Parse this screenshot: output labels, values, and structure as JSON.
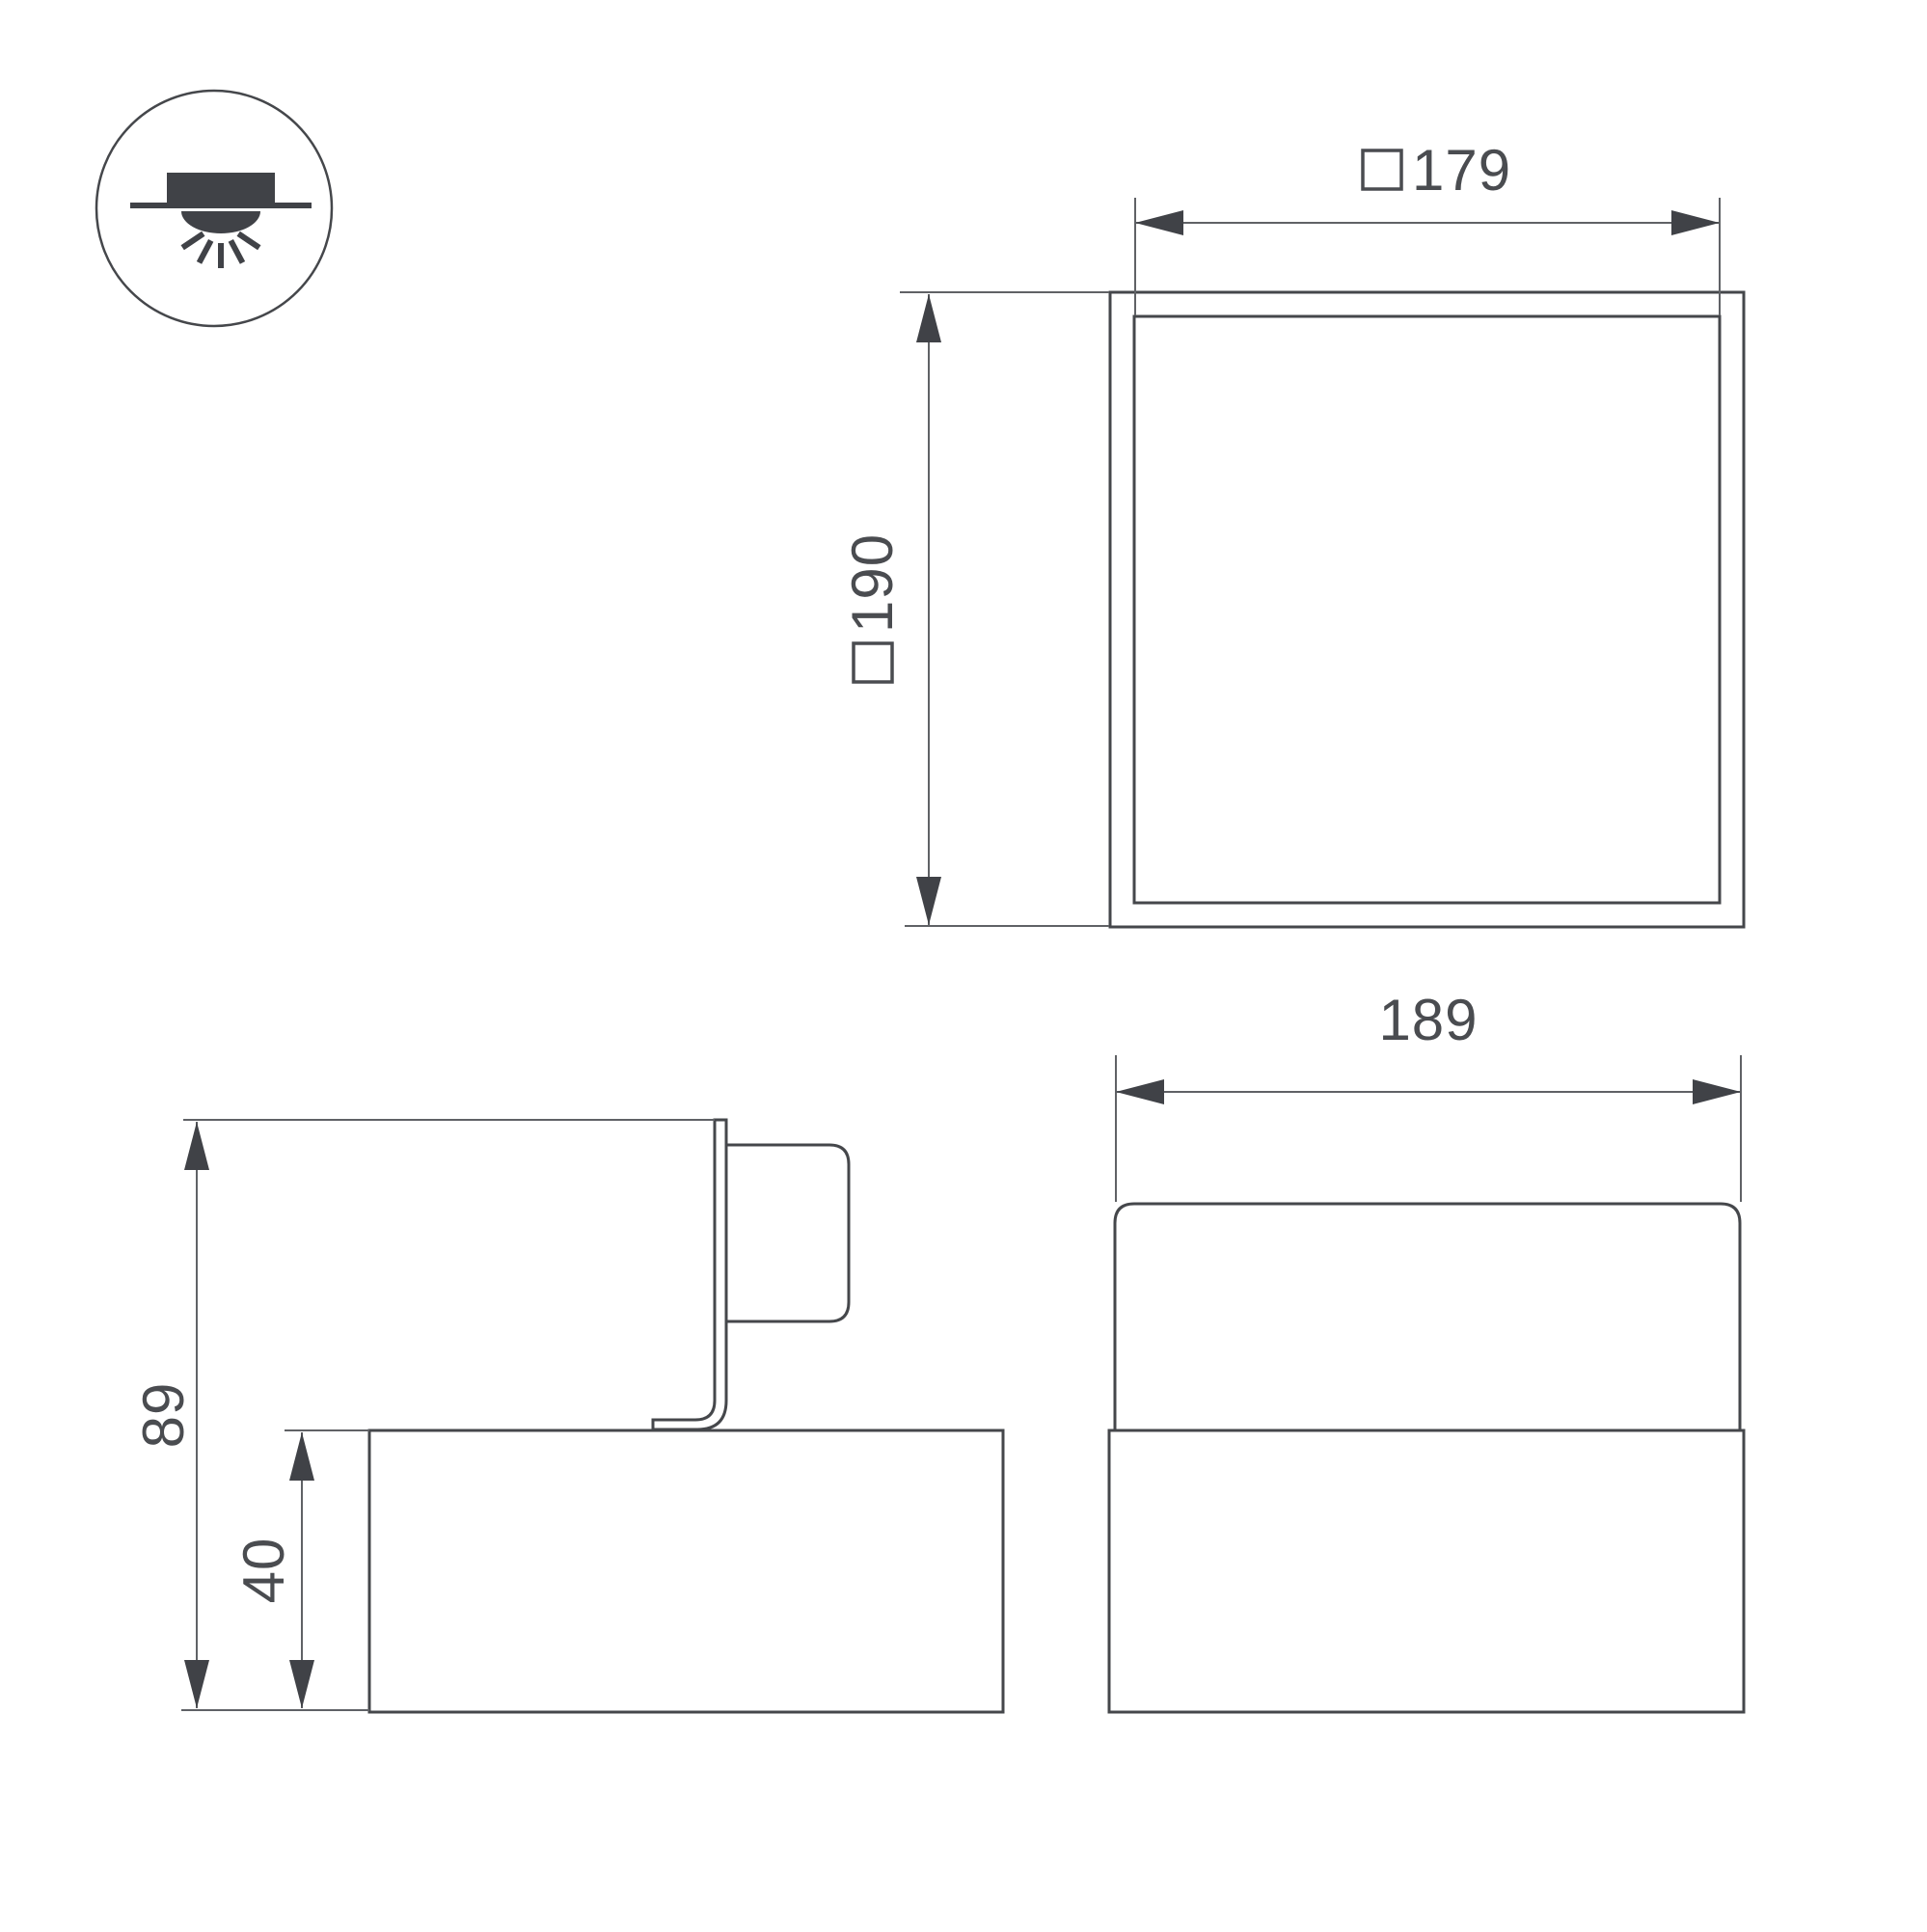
{
  "colors": {
    "background": "#ffffff",
    "object_line": "#45474b",
    "dimension_line": "#606266",
    "arrow": "#404247",
    "text": "#4a4c50"
  },
  "badge": {
    "icon": "recessed-downlight-icon"
  },
  "top_view": {
    "width_dim": {
      "symbol": "□",
      "value": "179"
    },
    "size_dim": {
      "symbol": "□",
      "value": "190"
    }
  },
  "front_view": {
    "width_dim": {
      "value": "189"
    }
  },
  "side_view": {
    "overall_height_dim": {
      "value": "89"
    },
    "base_height_dim": {
      "value": "40"
    }
  }
}
